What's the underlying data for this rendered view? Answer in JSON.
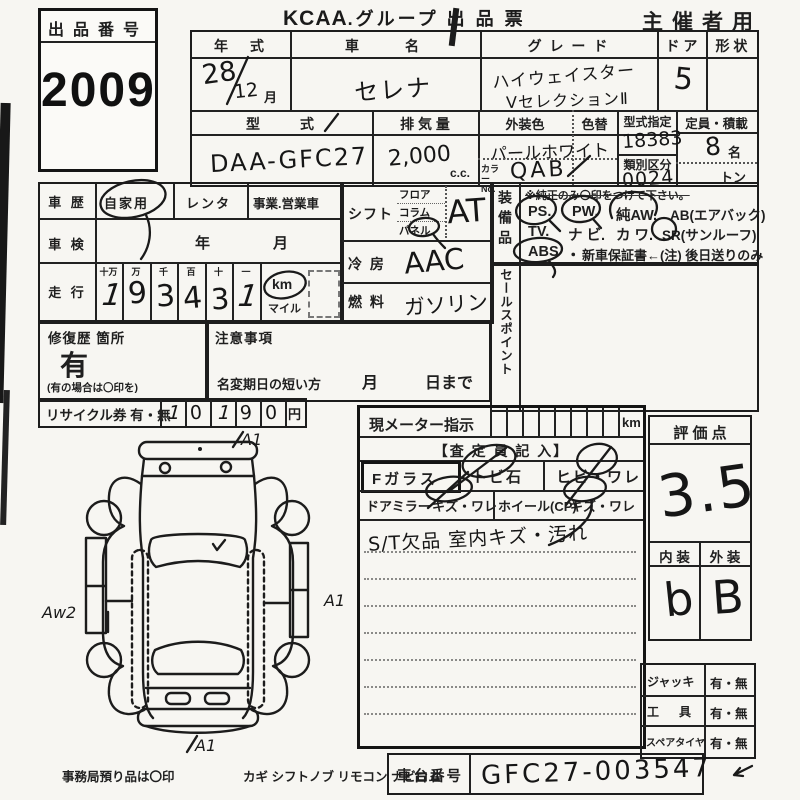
{
  "doc": {
    "lot": {
      "label": "出品番号",
      "number": "2009"
    },
    "title": {
      "brand": "KCAA",
      "rest": ".グループ 出 品 票"
    },
    "audience": "主催者用"
  },
  "vehicle": {
    "year": {
      "label": "年　式",
      "value": "28",
      "month": "12",
      "month_suffix": "月"
    },
    "name": {
      "label": "車　　名",
      "value": "セレナ"
    },
    "grade": {
      "label": "グ レ ー ド",
      "line1": "ハイウェイスター",
      "line2": "VセレクションⅡ"
    },
    "door": {
      "label": "ド ア",
      "value": "5"
    },
    "shape": {
      "label": "形 状",
      "value": ""
    },
    "model": {
      "label": "型　　式",
      "value": "DAA-GFC27"
    },
    "displacement": {
      "label": "排 気 量",
      "value": "2,000",
      "unit": "c.c."
    },
    "ext_color": {
      "label": "外装色",
      "value": "パールホワイト",
      "color_no_label": "カラーNo.",
      "color_no": "QAB"
    },
    "color_change": {
      "label": "色替",
      "value": "/"
    },
    "type_designation": {
      "label": "型式指定",
      "value": "18383"
    },
    "class_division": {
      "label": "類別区分",
      "value": "0024"
    },
    "capacity": {
      "label": "定員・積載",
      "value": "8",
      "unit": "名",
      "ton": "トン"
    }
  },
  "history": {
    "label": "車 歴",
    "options": [
      "自家用",
      "レンタ",
      "事業.営業車"
    ],
    "selected": "自家用",
    "inspection": {
      "label": "車 検",
      "year_label": "年",
      "month_label": "月"
    }
  },
  "mileage": {
    "label": "走 行",
    "place_headers": [
      "十万",
      "万",
      "千",
      "百",
      "十",
      "一"
    ],
    "digits": [
      "1",
      "9",
      "3",
      "4",
      "3",
      "1"
    ],
    "unit_km": "km",
    "unit_mile": "マイル"
  },
  "repair": {
    "label": "修復歴 箇所",
    "value": "有",
    "note": "(有の場合は〇印を)"
  },
  "caution": {
    "label": "注意事項",
    "rename_label": "名変期日の短い方",
    "month_label": "月",
    "day_label": "日まで"
  },
  "recycle": {
    "label": "リサイクル券 有・無",
    "digits": [
      "1",
      "0",
      "1",
      "9",
      "0"
    ],
    "unit": "円"
  },
  "controls": {
    "shift": {
      "label": "シフト",
      "options": [
        "フロア",
        "コラム",
        "パネル"
      ],
      "selected": "パネル",
      "value": "AT"
    },
    "aircon": {
      "label": "冷 房",
      "value": "AAC"
    },
    "fuel": {
      "label": "燃 料",
      "value": "ガソリン"
    }
  },
  "equipment": {
    "label": "装備品",
    "note": "※純正のみ〇印をつけて下さい。",
    "items1": [
      "PS.",
      "PW.",
      "純AW.",
      "AB(エアバック)"
    ],
    "items2": [
      "TV.",
      "ナ ビ.",
      "カ ワ.",
      "SR(サンルーフ)"
    ],
    "items3": [
      "ABS",
      "・",
      "新車保証書←(注) 後日送りのみ"
    ],
    "circled": [
      "PS",
      "PW",
      "純AW",
      "SR",
      "ABS"
    ]
  },
  "sales_point": {
    "label": "セールスポイント"
  },
  "meter": {
    "label": "現メーター指示",
    "unit": "km",
    "assessor_label": "【査 定 員 記 入】",
    "row1": [
      "Fガラス",
      "トビ石",
      "ヒビ・ワレ"
    ],
    "row2": [
      "ドアミラー",
      "キズ・ワレ",
      "ホイール(CP)",
      "キズ・ワレ"
    ],
    "note": "S/T欠品  室内キズ・汚れ"
  },
  "rating": {
    "label": "評 価 点",
    "value": "3.5",
    "interior_label": "内 装",
    "interior_value": "b",
    "exterior_label": "外 装",
    "exterior_value": "B"
  },
  "accessories": {
    "rows": [
      {
        "label": "ジャッキ",
        "value": "有・無"
      },
      {
        "label": "工　具",
        "value": "有・無"
      },
      {
        "label": "スペアタイヤ",
        "value": "有・無"
      }
    ]
  },
  "chassis": {
    "label": "車台番号",
    "value": "GFC27-003547"
  },
  "footer": {
    "deposit_note": "事務局預り品は〇印",
    "items": "カギ  シフトノブ  リモコン  ナビロム"
  },
  "diagram": {
    "annotations": {
      "top": "A1",
      "right": "A1",
      "left": "Aw2",
      "bottom": "A1"
    }
  }
}
